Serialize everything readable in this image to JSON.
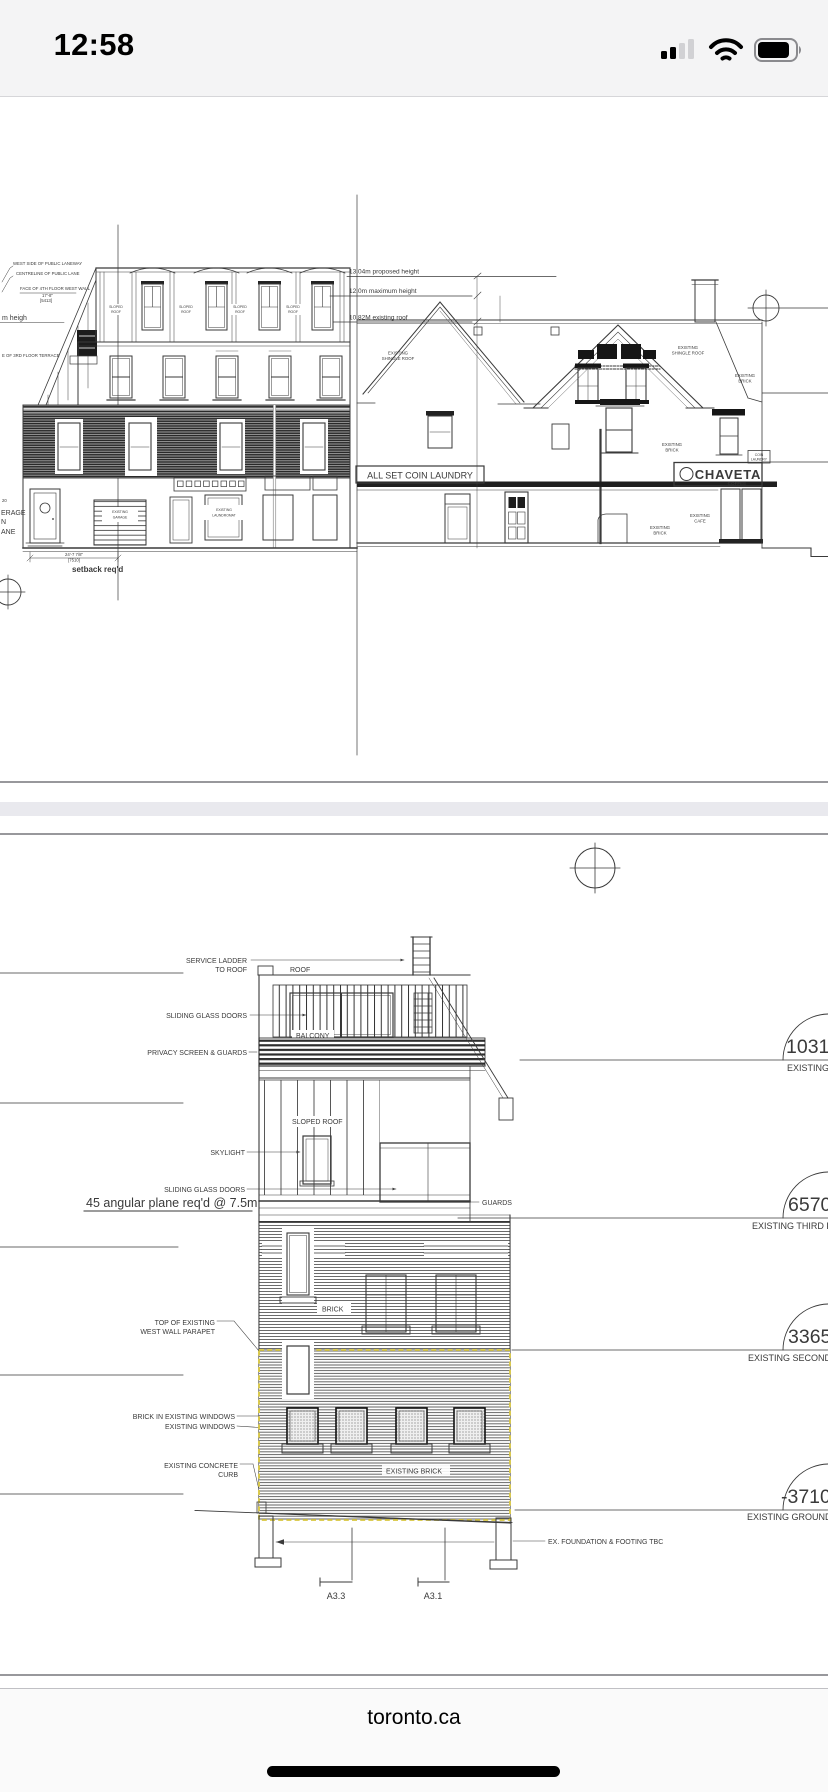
{
  "status_bar": {
    "time": "12:58"
  },
  "footer": {
    "site": "toronto.ca"
  },
  "colors": {
    "highlight_dash": "#d8c63f"
  },
  "words": {
    "existing": "EXISTING",
    "shingle_roof": "SHINGLE ROOF",
    "brick": "BRICK",
    "cafe": "CAFE",
    "garage": "GARAGE",
    "laundromat": "LAUNDROMAT",
    "sloped": "SLOPED",
    "roof": "ROOF"
  },
  "sheet1": {
    "heights": {
      "proposed": "13.04m proposed height",
      "maximum": "12.0m maximum height",
      "existing_roof": "10.82M existing roof"
    },
    "notes": {
      "laneway": "WEST SIDE OF PUBLIC LANEWAY",
      "centreline": "CENTRELINE OF PUBLIC LANE",
      "face_wall": "FACE OF 4TH FLOOR WEST WALL",
      "dim_a": "17'-8\"",
      "dim_a_mm": "[5413]",
      "m_heigh": "m heigh",
      "terrace": "E OF 3RD FLOOR TERRACE",
      "num20": "20",
      "coverage": "ERAGE",
      "coverage2": "N",
      "lane": "ANE",
      "setback": "setback req'd",
      "dim_b": "24'-7 7/8\"",
      "dim_b_mm": "[7510]"
    },
    "signs": {
      "laundry": "ALL SET COIN LAUNDRY",
      "chaveta": "CHAVETA",
      "coffee": "COFFEE",
      "coin": "COIN",
      "laundry_small": "LAUNDRY"
    }
  },
  "sheet2": {
    "callouts": {
      "service_ladder_1": "SERVICE LADDER",
      "service_ladder_2": "TO ROOF",
      "roof": "ROOF",
      "sliding_glass_doors": "SLIDING GLASS DOORS",
      "balcony": "BALCONY",
      "privacy": "PRIVACY SCREEN & GUARDS",
      "sloped_roof": "SLOPED ROOF",
      "skylight": "SKYLIGHT",
      "angular": "45 angular plane req'd @ 7.5m",
      "guards": "GUARDS",
      "parapet_1": "TOP OF EXISTING",
      "parapet_2": "WEST WALL PARAPET",
      "brick": "BRICK",
      "brick_in": "BRICK IN EXISTING WINDOWS",
      "existing_windows": "EXISTING WINDOWS",
      "curb_1": "EXISTING CONCRETE",
      "curb_2": "CURB",
      "existing_brick": "EXISTING BRICK",
      "foundation": "EX.    FOUNDATION & FOOTING TBC",
      "a33": "A3.3",
      "a31": "A3.1"
    },
    "levels": [
      {
        "value": "1031",
        "label": "EXISTING"
      },
      {
        "value": "6570",
        "label": "EXISTING THIRD F"
      },
      {
        "value": "3365",
        "label": "EXISTING SECOND F"
      },
      {
        "value": "-3710",
        "label": "EXISTING GROUND F"
      }
    ]
  }
}
